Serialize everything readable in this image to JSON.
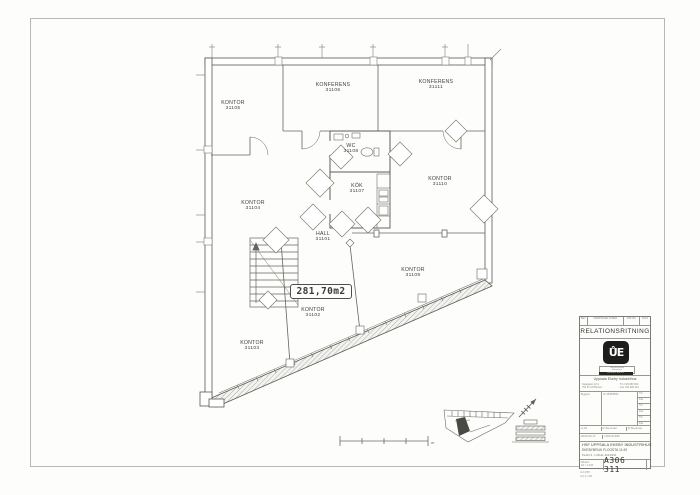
{
  "document": {
    "type": "RELATIONSRITNING",
    "drawing_number": "A306 311"
  },
  "plan": {
    "area_label": "281,70m2",
    "scale_unit": "m",
    "rooms": [
      {
        "name": "KONTOR",
        "number": "31105"
      },
      {
        "name": "KONFERENS",
        "number": "31106"
      },
      {
        "name": "KONFERENS",
        "number": "31111"
      },
      {
        "name": "WC",
        "number": "31108"
      },
      {
        "name": "KÖK",
        "number": "31107"
      },
      {
        "name": "KONTOR",
        "number": "31110"
      },
      {
        "name": "KONTOR",
        "number": "31104"
      },
      {
        "name": "HALL",
        "number": "31101"
      },
      {
        "name": "KONTOR",
        "number": "31109"
      },
      {
        "name": "KONTOR",
        "number": "31102"
      },
      {
        "name": "KONTOR",
        "number": "31103"
      }
    ]
  },
  "title_block": {
    "header_cells": [
      "BET",
      "ÄNDRINGEN AVSER",
      "DATUM",
      "SIGN"
    ],
    "doc_type": "RELATIONSRITNING",
    "logo_glyph": "ŮE",
    "logo_card_lines": [
      "Uppsala Ekeby",
      "Industrihus"
    ],
    "logo_band": "EKEBYBRUK",
    "company": "Uppsala Ekeby Industrihus",
    "address_left": [
      "Salagatan 18 A",
      "753 30 UPPSALA"
    ],
    "address_right": [
      "Tfn 018-480 600",
      "Fax 018-480 601"
    ],
    "grid_left_label": "Bygglov",
    "grid_mid_value": "Nr 4538/5566",
    "grid_right_rows": [
      "Tfn",
      "Fax",
      "Tfn",
      "Fax",
      "Tfn",
      "Fax"
    ],
    "sign_row": [
      "A-01",
      "R Stenman",
      "R Stenman"
    ],
    "date_row": [
      "2003-05-17",
      "I FROLUND"
    ],
    "project_line1": "HSF UPPSALA EKEBY INDUSTRIHUS",
    "project_line2": "EKEBYBRUK FLOGSTA 11:49",
    "project_line3": "PLAN 3 - LOKAL 3013/311",
    "scale_label": "SKALA",
    "scale_value": "A3 = 1:100",
    "drawing_number": "A306 311",
    "plot_stamp": [
      "A3-358",
      "A3-1:100"
    ]
  }
}
